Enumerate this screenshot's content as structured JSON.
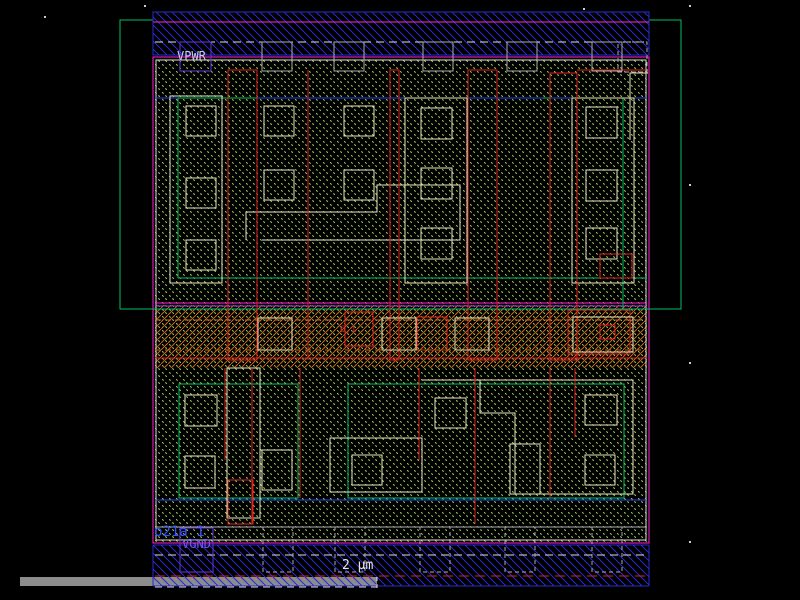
{
  "window": {
    "type": "vlsi-layout-viewer",
    "background": "#000000"
  },
  "cell": {
    "instance_label": "o21a_1",
    "array_marker": "6,1",
    "ports": {
      "power": "VPWR",
      "ground": "VGND"
    }
  },
  "scale_bar": {
    "label": "2 µm"
  },
  "colors": {
    "metal1_hatch": "#2A2ACF",
    "metal1_bright": "#2244EE",
    "diff_hatch": "#A8E060",
    "poly": "#E02020",
    "nwell_outline": "#00C060",
    "boundary": "#FF22CC",
    "li_outline": "#E6E6C0",
    "well_line": "#9933EE",
    "contact_gray": "#AAAAAA",
    "port_purple": "#6633DD",
    "label_power": "#CCCCEE",
    "label_ground": "#7755EE",
    "label_instance": "#3355FF",
    "scalebar_gray": "#8C8C8C",
    "ruler_text": "#E8E8E8",
    "orange_hatch": "#CC6A1A",
    "marker_red": "#D03020"
  }
}
